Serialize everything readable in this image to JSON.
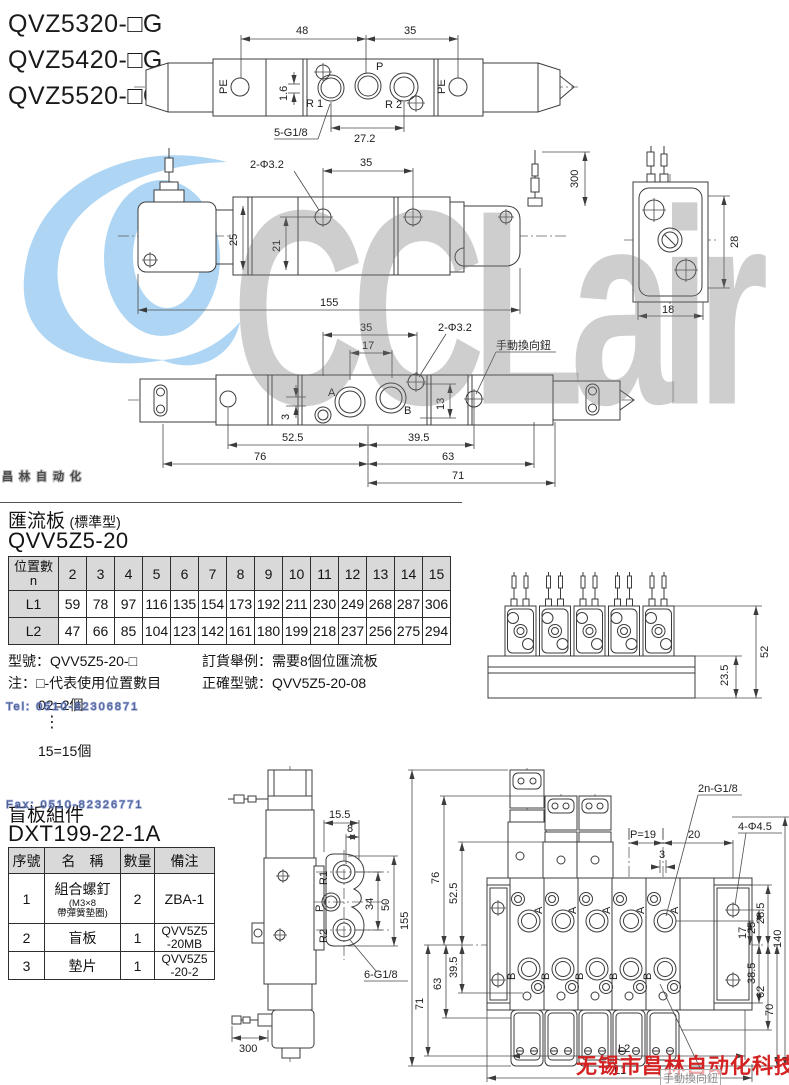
{
  "models": [
    "QVZ5320-□G",
    "QVZ5420-□G",
    "QVZ5520-□G"
  ],
  "wm": {
    "logo": "CCLair",
    "big_cn": "昌林自动化",
    "tel": "Tel: 0510-82306871",
    "fax": "Fax: 0510-82326771",
    "company": "无锡市昌林自动化科技",
    "stamp": "手動換向鈕"
  },
  "d1": {
    "w48": "48",
    "w35": "35",
    "pe": "PE",
    "p": "P",
    "r1": "R 1",
    "r2": "R 2",
    "t16": "1.6",
    "g": "5-G1/8",
    "w272": "27.2"
  },
  "d2": {
    "holes": "2-Φ3.2",
    "w35": "35",
    "wire": "300",
    "h25": "25",
    "h21": "21",
    "len": "155",
    "w18": "18",
    "h28": "28"
  },
  "d3": {
    "w35": "35",
    "w17": "17",
    "holes": "2-Φ3.2",
    "manual": "手動換向鈕",
    "a": "A",
    "b": "B",
    "h3": "3",
    "h13": "13",
    "w525": "52.5",
    "w395": "39.5",
    "w76": "76",
    "w63": "63",
    "w71": "71"
  },
  "mf": {
    "title": "匯流板",
    "subtitle": "(標準型)",
    "model": "QVV5Z5-20",
    "head1": "位置數",
    "head2": "n",
    "cols": [
      "2",
      "3",
      "4",
      "5",
      "6",
      "7",
      "8",
      "9",
      "10",
      "11",
      "12",
      "13",
      "14",
      "15"
    ],
    "l1": "L1",
    "l1v": [
      "59",
      "78",
      "97",
      "116",
      "135",
      "154",
      "173",
      "192",
      "211",
      "230",
      "249",
      "268",
      "287",
      "306"
    ],
    "l2": "L2",
    "l2v": [
      "47",
      "66",
      "85",
      "104",
      "123",
      "142",
      "161",
      "180",
      "199",
      "218",
      "237",
      "256",
      "275",
      "294"
    ],
    "note1": "型號：QVV5Z5-20-□",
    "note2": "注：□-代表使用位置數目",
    "note3": "02=2個",
    "dots": "⋮",
    "note4": "15=15個",
    "order1": "訂貨舉例：需要8個位匯流板",
    "order2": "正確型號：QVV5Z5-20-08",
    "d52": "52",
    "d235": "23.5"
  },
  "blank": {
    "title": "盲板組件",
    "model": "DXT199-22-1A",
    "h_no": "序號",
    "h_name": "名　稱",
    "h_qty": "數量",
    "h_note": "備注",
    "r1no": "1",
    "r1name": "組合螺釘",
    "r1sub1": "(M3×8",
    "r1sub2": "帶彈簧墊圈)",
    "r1qty": "2",
    "r1note": "ZBA-1",
    "r2no": "2",
    "r2name": "盲板",
    "r2qty": "1",
    "r2note1": "QVV5Z5",
    "r2note2": "-20MB",
    "r3no": "3",
    "r3name": "墊片",
    "r3qty": "1",
    "r3note1": "QVV5Z5",
    "r3note2": "-20-2"
  },
  "d4": {
    "w155": "15.5",
    "w8": "8",
    "r1": "R1",
    "p": "P",
    "r2": "R2",
    "h34": "34",
    "h50": "50",
    "g": "6-G1/8",
    "wire": "300"
  },
  "d5": {
    "g": "2n-G1/8",
    "p19": "P=19",
    "w20": "20",
    "w3": "3",
    "holes": "4-Φ4.5",
    "h155": "155",
    "h71": "71",
    "h76": "76",
    "h525": "52.5",
    "h395": "39.5",
    "h63": "63",
    "r17": "17",
    "r25": "25",
    "r285": "28.5",
    "r385": "38.5",
    "r62": "62",
    "r70": "70",
    "r140": "140",
    "l1": "L1",
    "l2": "L2",
    "a": "A",
    "b": "B"
  }
}
